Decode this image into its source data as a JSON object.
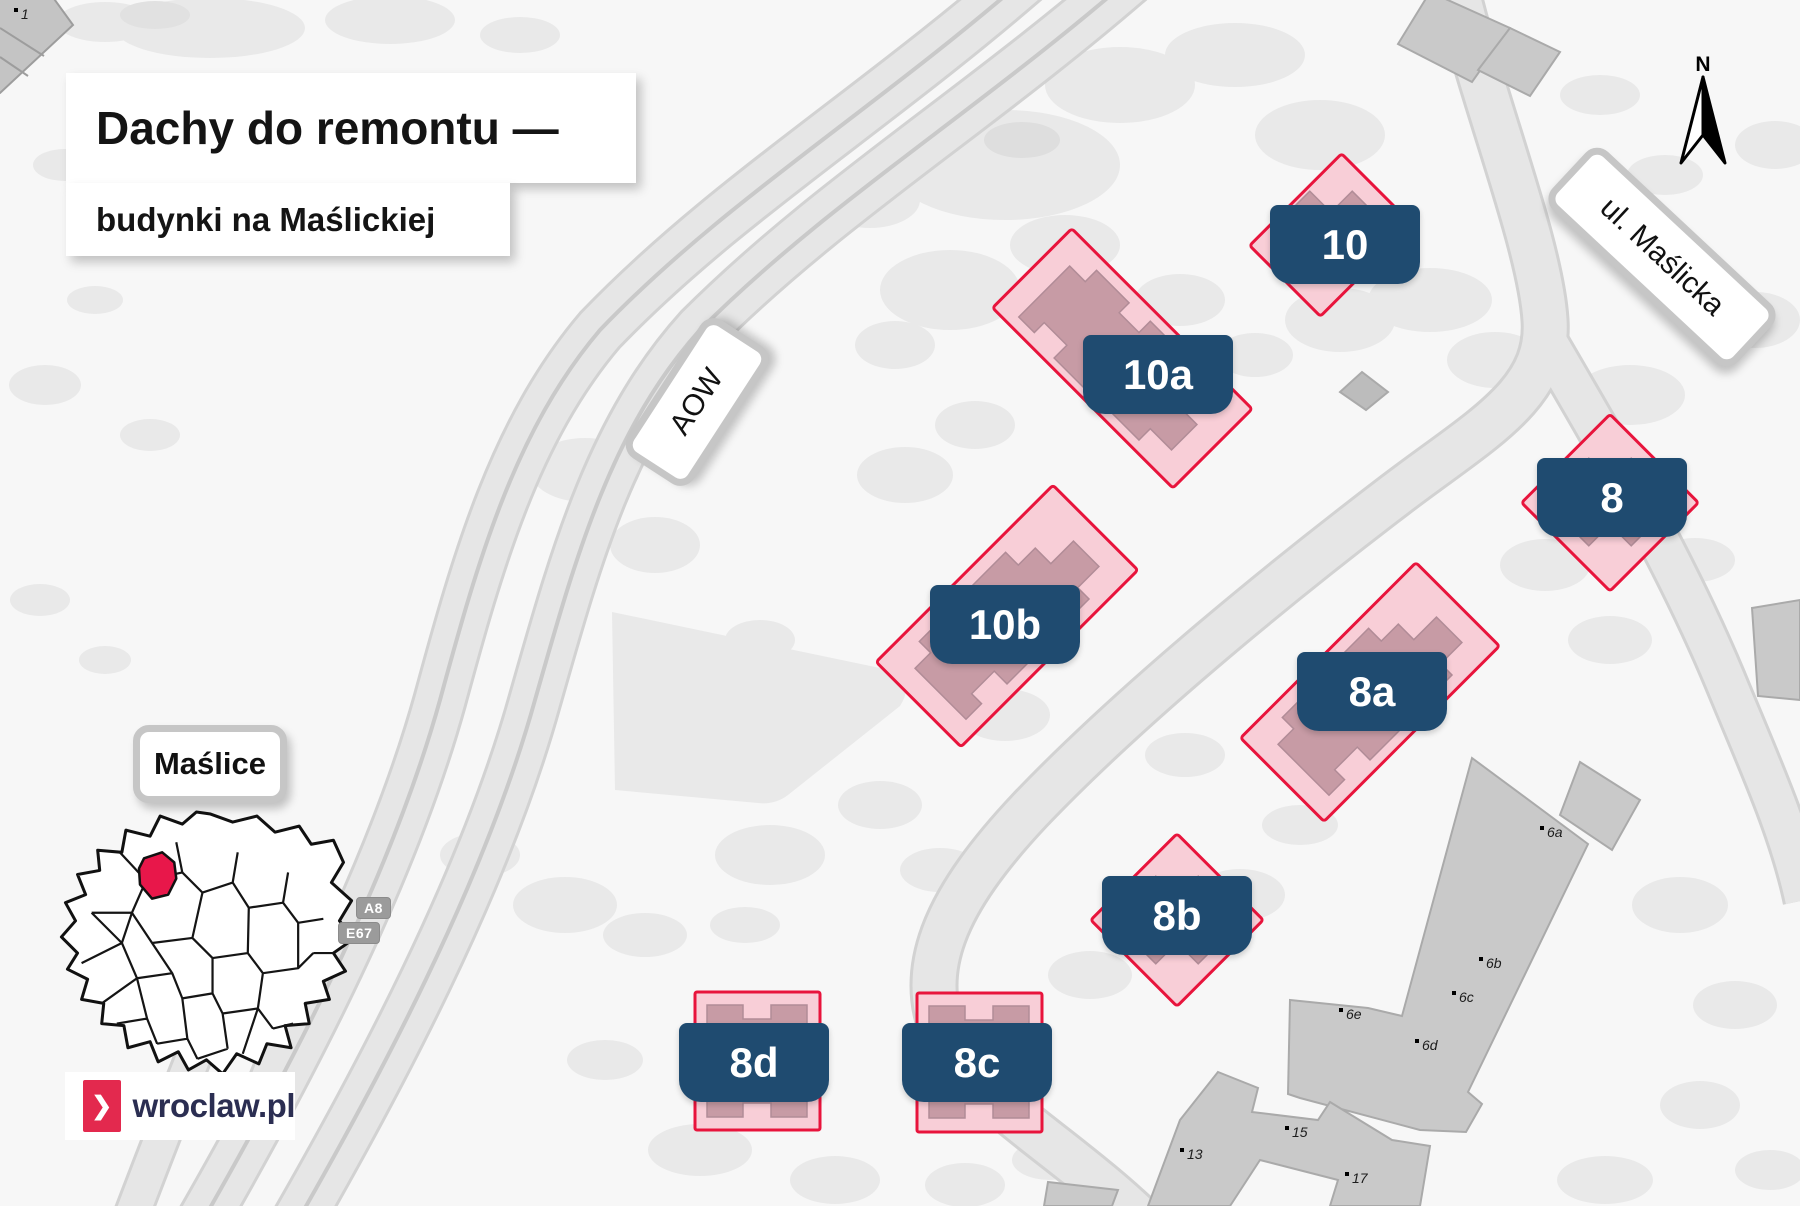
{
  "title_card": {
    "title": "Dachy do remontu —",
    "subtitle": "budynki na Maślickiej"
  },
  "map": {
    "road_labels": [
      {
        "id": "aow",
        "label": "AOW"
      },
      {
        "id": "maslicka",
        "label": "ul. Maślicka"
      }
    ],
    "district_label": "Maślice",
    "route_shields": [
      {
        "label": "A8"
      },
      {
        "label": "E67"
      }
    ],
    "compass": {
      "label": "N"
    },
    "highlighted_buildings": [
      {
        "label": "10"
      },
      {
        "label": "10a"
      },
      {
        "label": "10b"
      },
      {
        "label": "8"
      },
      {
        "label": "8a"
      },
      {
        "label": "8b"
      },
      {
        "label": "8c"
      },
      {
        "label": "8d"
      }
    ],
    "background_buildings": [
      {
        "label": "1"
      },
      {
        "label": "6a"
      },
      {
        "label": "6b"
      },
      {
        "label": "6c"
      },
      {
        "label": "6d"
      },
      {
        "label": "6e"
      },
      {
        "label": "13"
      },
      {
        "label": "15"
      },
      {
        "label": "17"
      }
    ]
  },
  "logo": {
    "text": "wroclaw.pl",
    "chevron": "❯"
  },
  "colors": {
    "highlight_fill": "#f8ced7",
    "highlight_border": "#e8143c",
    "footprint": "#c79ba5",
    "label_bg": "#1f4b70",
    "district_red": "#e8174a",
    "logo_red": "#e3294e",
    "logo_text": "#2b2e52"
  }
}
